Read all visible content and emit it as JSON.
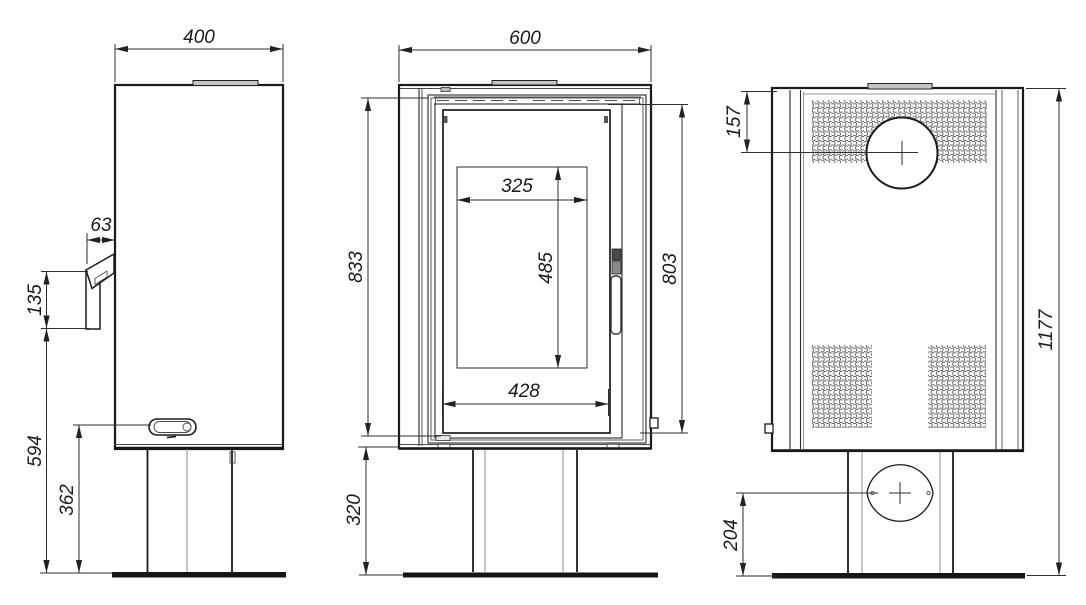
{
  "drawing": {
    "type": "stove-dimension-drawing",
    "views": {
      "side": "side-view",
      "front": "front-view",
      "rear": "rear-view"
    }
  },
  "dimensions": {
    "side": {
      "depth": "400",
      "handle_offset": "63",
      "handle_height": "135",
      "handle_bottom_height": "594",
      "connector_height": "362"
    },
    "front": {
      "width": "600",
      "door_frame_height": "833",
      "glass_view_width": "325",
      "glass_view_height": "485",
      "door_height": "803",
      "glass_width": "428",
      "pedestal_height": "320"
    },
    "rear": {
      "flue_center_from_top": "157",
      "total_height": "1177",
      "air_inlet_center_height": "204"
    }
  },
  "colors": {
    "outline": "#1b1b1b",
    "dimension_lines": "#2e2e2e",
    "text": "#1a1a1a",
    "panel_strip": "#c4c4c4",
    "background": "#ffffff"
  }
}
